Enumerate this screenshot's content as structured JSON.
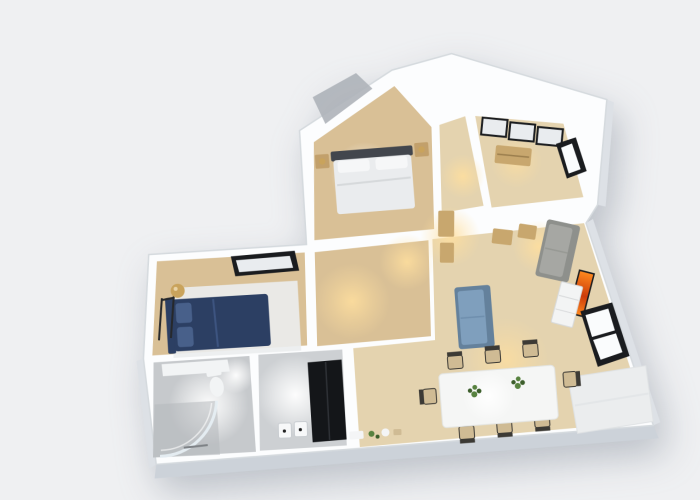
{
  "scene": {
    "type": "3d-floor-plan-render",
    "view": "top-down-dollhouse",
    "visible_text": "none"
  },
  "palette": {
    "background": "#eff0f2",
    "wall_white": "#fcfdfe",
    "wall_edge": "#d5dade",
    "wall_face": "#dde1e6",
    "wall_face_dark": "#ccd2d9",
    "wood": "#d9c096",
    "wood_light": "#e4d3af",
    "tile": "#c6c9cc",
    "tile_light": "#cdd0d3",
    "tile_dark": "#b4b8bc",
    "terrace_gray": "#aeb3b9",
    "glow_warm": "#ffdf9e",
    "glow_white": "#ffffff",
    "headboard_gray": "#42464d",
    "bedding_white": "#eaecee",
    "pillow_white": "#f6f7f8",
    "nightstand_wood": "#c2a06b",
    "lamp_gold": "#c9a35c",
    "bed_navy": "#2c3f63",
    "bed_navy_light": "#48608a",
    "rug_white": "#ebedee",
    "rack_black": "#26282b",
    "frame_black": "#1a1c1f",
    "panel_white": "#e9ecef",
    "glass_light": "#e6eef3",
    "toilet_white": "#f2f4f5",
    "fridge_black": "#141619",
    "fridge_hl": "#2e3136",
    "switch_white": "#f7f8f9",
    "sofa_gray": "#a6a7a3",
    "sofa_gray_dark": "#8e908c",
    "table_wood": "#c8a76e",
    "sofa_blue": "#7f9fbd",
    "sofa_blue_dark": "#64819c",
    "art_orange": "#ff8a1e",
    "art_red": "#cc3b0a",
    "cabinet_white": "#f3f4f4",
    "cabinet_line": "#d8dadb",
    "dining_white": "#f5f6f5",
    "chair_frame": "#3c3a35",
    "chair_seat": "#cfbb94",
    "plant_green": "#57823f",
    "plant_dark": "#3c5e2b",
    "window_white": "#fafcfd",
    "decor_white": "#f4f5f6"
  },
  "rooms": [
    {
      "id": "bedroom-main",
      "floor": "wood",
      "furniture": [
        "double-bed",
        "headboard",
        "pillows",
        "nightstand-left",
        "nightstand-right",
        "gold-table-lamps"
      ]
    },
    {
      "id": "bedroom-second",
      "floor": "wood",
      "furniture": [
        "sliding-wardrobe",
        "dresser",
        "right-wall-window"
      ]
    },
    {
      "id": "bedroom-left",
      "floor": "wood",
      "furniture": [
        "navy-bed",
        "area-rug",
        "clothes-rack",
        "gold-floor-lamp",
        "skylight-panel"
      ]
    },
    {
      "id": "bathroom",
      "floor": "tile",
      "furniture": [
        "curved-glass-shower",
        "toilet",
        "vanity-counter"
      ]
    },
    {
      "id": "kitchen",
      "floor": "tile",
      "furniture": [
        "refrigerator",
        "wall-switches"
      ]
    },
    {
      "id": "hallway",
      "floor": "wood",
      "furniture": []
    },
    {
      "id": "corridor-top",
      "floor": "wood",
      "furniture": []
    },
    {
      "id": "living-dining",
      "floor": "wood",
      "furniture": [
        "dining-table",
        "dining-chairs-x8",
        "table-plants-x2",
        "gray-sofa",
        "blue-sofa",
        "side-tables",
        "desk-cabinets",
        "orange-artwork",
        "white-sideboard",
        "double-window",
        "corner-rug",
        "floor-decor"
      ]
    }
  ],
  "lights": [
    {
      "room": "bathroom",
      "tone": "white"
    },
    {
      "room": "kitchen",
      "tone": "white"
    },
    {
      "room": "hallway",
      "tone": "warm"
    },
    {
      "room": "bedroom-left",
      "tone": "warm"
    },
    {
      "room": "bedroom-main",
      "tone": "warm"
    },
    {
      "room": "corridor-top",
      "tone": "warm"
    },
    {
      "room": "bedroom-second",
      "tone": "warm"
    },
    {
      "room": "living-dining",
      "tone": "warm-white"
    }
  ]
}
